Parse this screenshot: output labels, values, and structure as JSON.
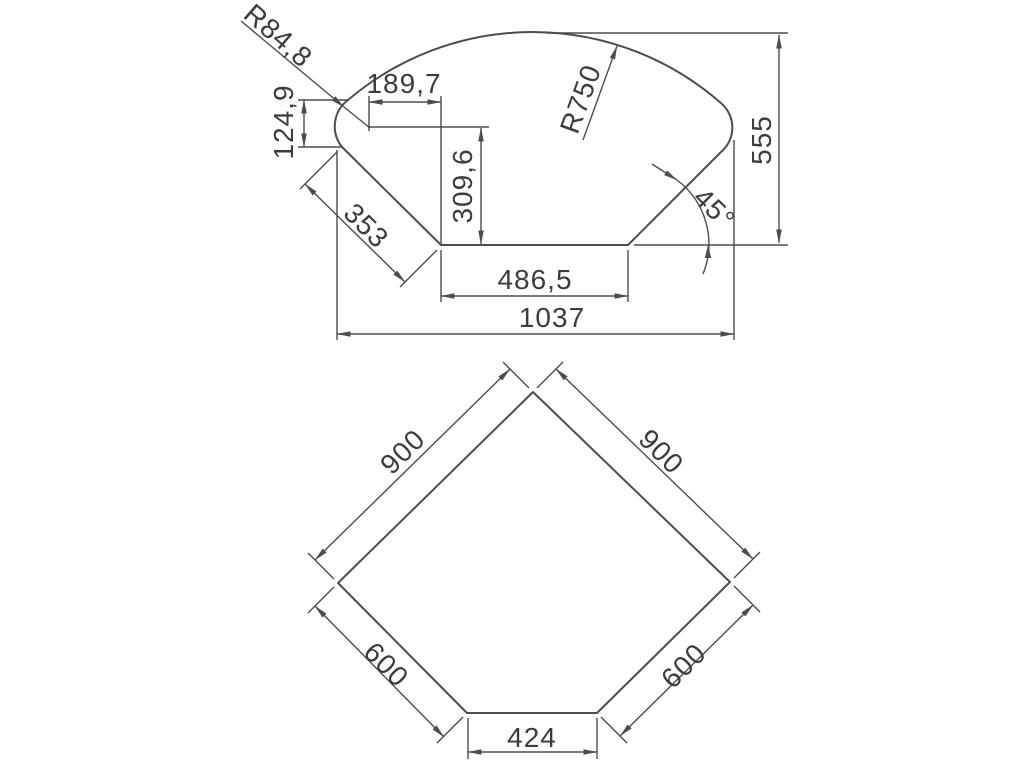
{
  "drawing": {
    "background": "#ffffff",
    "line_color": "#4d4d4d",
    "text_color": "#3c3c3c",
    "top_view": {
      "labels": {
        "corner_radius": "R84,8",
        "offset_width": "189,7",
        "corner_height": "124,9",
        "front_radius": "R750",
        "overall_height": "555",
        "left_edge": "353",
        "inner_height": "309,6",
        "angle": "45°",
        "back_edge": "486,5",
        "overall_width": "1037"
      }
    },
    "bottom_view": {
      "labels": {
        "left_side": "900",
        "right_side": "900",
        "front_left": "600",
        "front_right": "600",
        "front_edge": "424"
      }
    }
  }
}
